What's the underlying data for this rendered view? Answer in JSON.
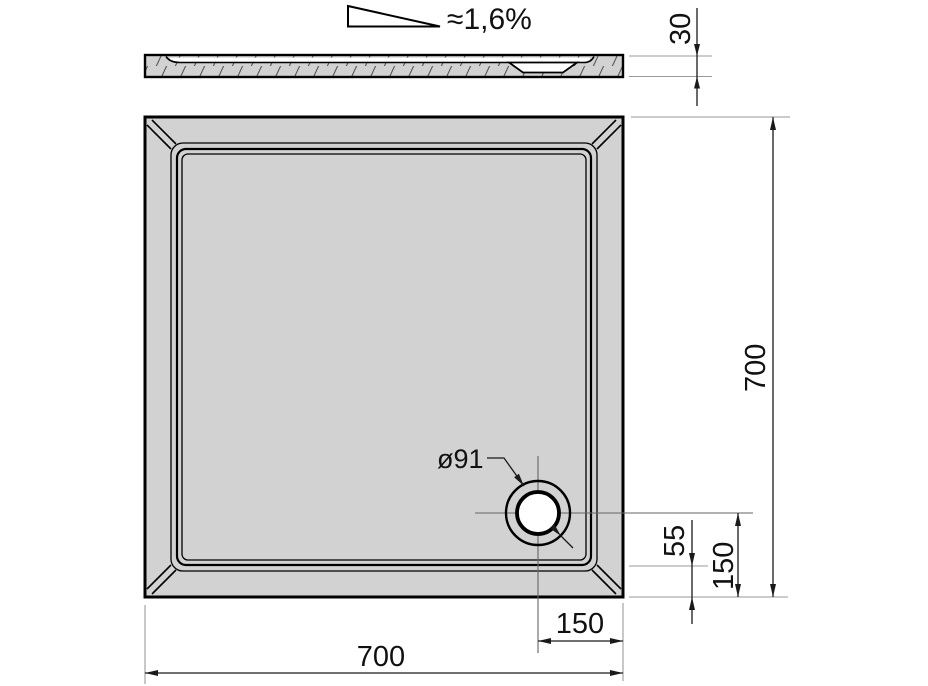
{
  "section_view": {
    "slope_label": "≈1,6%",
    "thickness_dim": "30"
  },
  "plan_view": {
    "drain_diameter_dim": "ø91",
    "overall_depth_dim": "700",
    "overall_width_dim": "700",
    "drain_center_to_bottom_dim": "150",
    "drain_center_to_right_dim": "150",
    "floor_edge_to_bottom_dim": "55"
  },
  "colors": {
    "tray_fill": "#d2d2d2",
    "outline": "#000000",
    "dimension_line": "#1a1a1a",
    "extension_line": "#9a9a9a",
    "center_line": "#666666",
    "drain_fill": "#ffffff",
    "hatch_line": "#565656"
  }
}
